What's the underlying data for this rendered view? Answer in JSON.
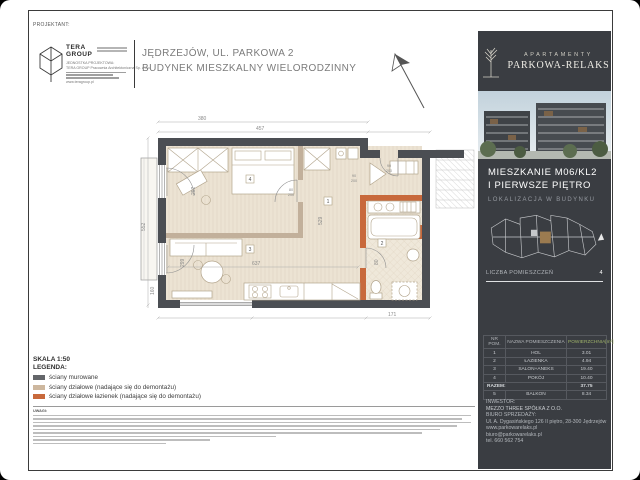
{
  "header": {
    "projektant_label": "PROJEKTANT:",
    "designer_name": "TERA\nGROUP",
    "designer_sub1": "JEDNOSTKA PROJEKTOWA:",
    "designer_sub2": "TERA GROUP Pracownia Architektoniczna Sp. z o.o.",
    "designer_web": "www.teragroup.pl",
    "title_line1": "JĘDRZEJÓW, UL. PARKOWA 2",
    "title_line2": "BUDYNEK MIESZKALNY WIELORODZINNY"
  },
  "brand": {
    "top": "APARTAMENTY",
    "name": "PARKOWA-RELAKS"
  },
  "panel": {
    "apartment_line1": "MIESZKANIE M06/KL2",
    "apartment_line2": "I PIERWSZE PIĘTRO",
    "location_label": "LOKALIZACJA W BUDYNKU",
    "rooms_label": "LICZBA POMIESZCZEŃ",
    "rooms_value": "4",
    "table": {
      "headers": [
        "NR POM.",
        "NAZWA POMIESZCZENIA",
        "POWIERZCHNIA[m²]"
      ],
      "rows": [
        {
          "nr": "1",
          "name": "HOL",
          "area": "3.01"
        },
        {
          "nr": "2",
          "name": "ŁAZIENKA",
          "area": "4.94"
        },
        {
          "nr": "3",
          "name": "SALON+ANEKS",
          "area": "19.40"
        },
        {
          "nr": "4",
          "name": "POKÓJ",
          "area": "10.40"
        }
      ],
      "total_label": "RAZEM:",
      "total_area": "37.75",
      "balkon": {
        "nr": "5",
        "name": "BALKON",
        "area": "8.34"
      }
    },
    "investor": {
      "label": "INWESTOR:",
      "company": "MEZZO THREE SPÓŁKA Z O.O.",
      "office_label": "BIURO SPRZEDAŻY:",
      "address": "Ul. A. Dygasińskiego 126 II piętro, 28-300 Jędrzejów",
      "www": "www.parkowarelaks.pl",
      "email": "biuro@parkowarelaks.pl",
      "phone": "tel. 660 562 754"
    }
  },
  "legend": {
    "scale": "SKALA 1:50",
    "label": "LEGENDA:",
    "items": [
      {
        "label": "ściany murowane",
        "color": "#64666a"
      },
      {
        "label": "ściany działowe (nadające się do demontażu)",
        "color": "#cdb79e"
      },
      {
        "label": "ściany działowe łazienek (nadające się do demontażu)",
        "color": "#c8693c"
      }
    ]
  },
  "notes_label": "UWAGI:",
  "plan": {
    "badges": {
      "hol": "1",
      "lazienka": "2",
      "salon": "3",
      "pokoj": "4"
    },
    "dims": {
      "d380": "380",
      "d457": "457",
      "d552": "552",
      "d160": "160",
      "d292": "292",
      "d299": "299",
      "d529": "529",
      "d637": "637",
      "d171": "171",
      "d80": "80",
      "door1_w": "80",
      "door1_h": "200",
      "door2_w": "90",
      "door2_h": "200",
      "door3_w": "90",
      "door3_h": "200"
    }
  },
  "colors": {
    "panel_bg": "#3a3d42",
    "accent_green": "#9fb36a",
    "wall": "#4b4e53",
    "partition": "#c2b09b",
    "bathroom_wall": "#c8693c",
    "floor": "#ece3d3"
  }
}
